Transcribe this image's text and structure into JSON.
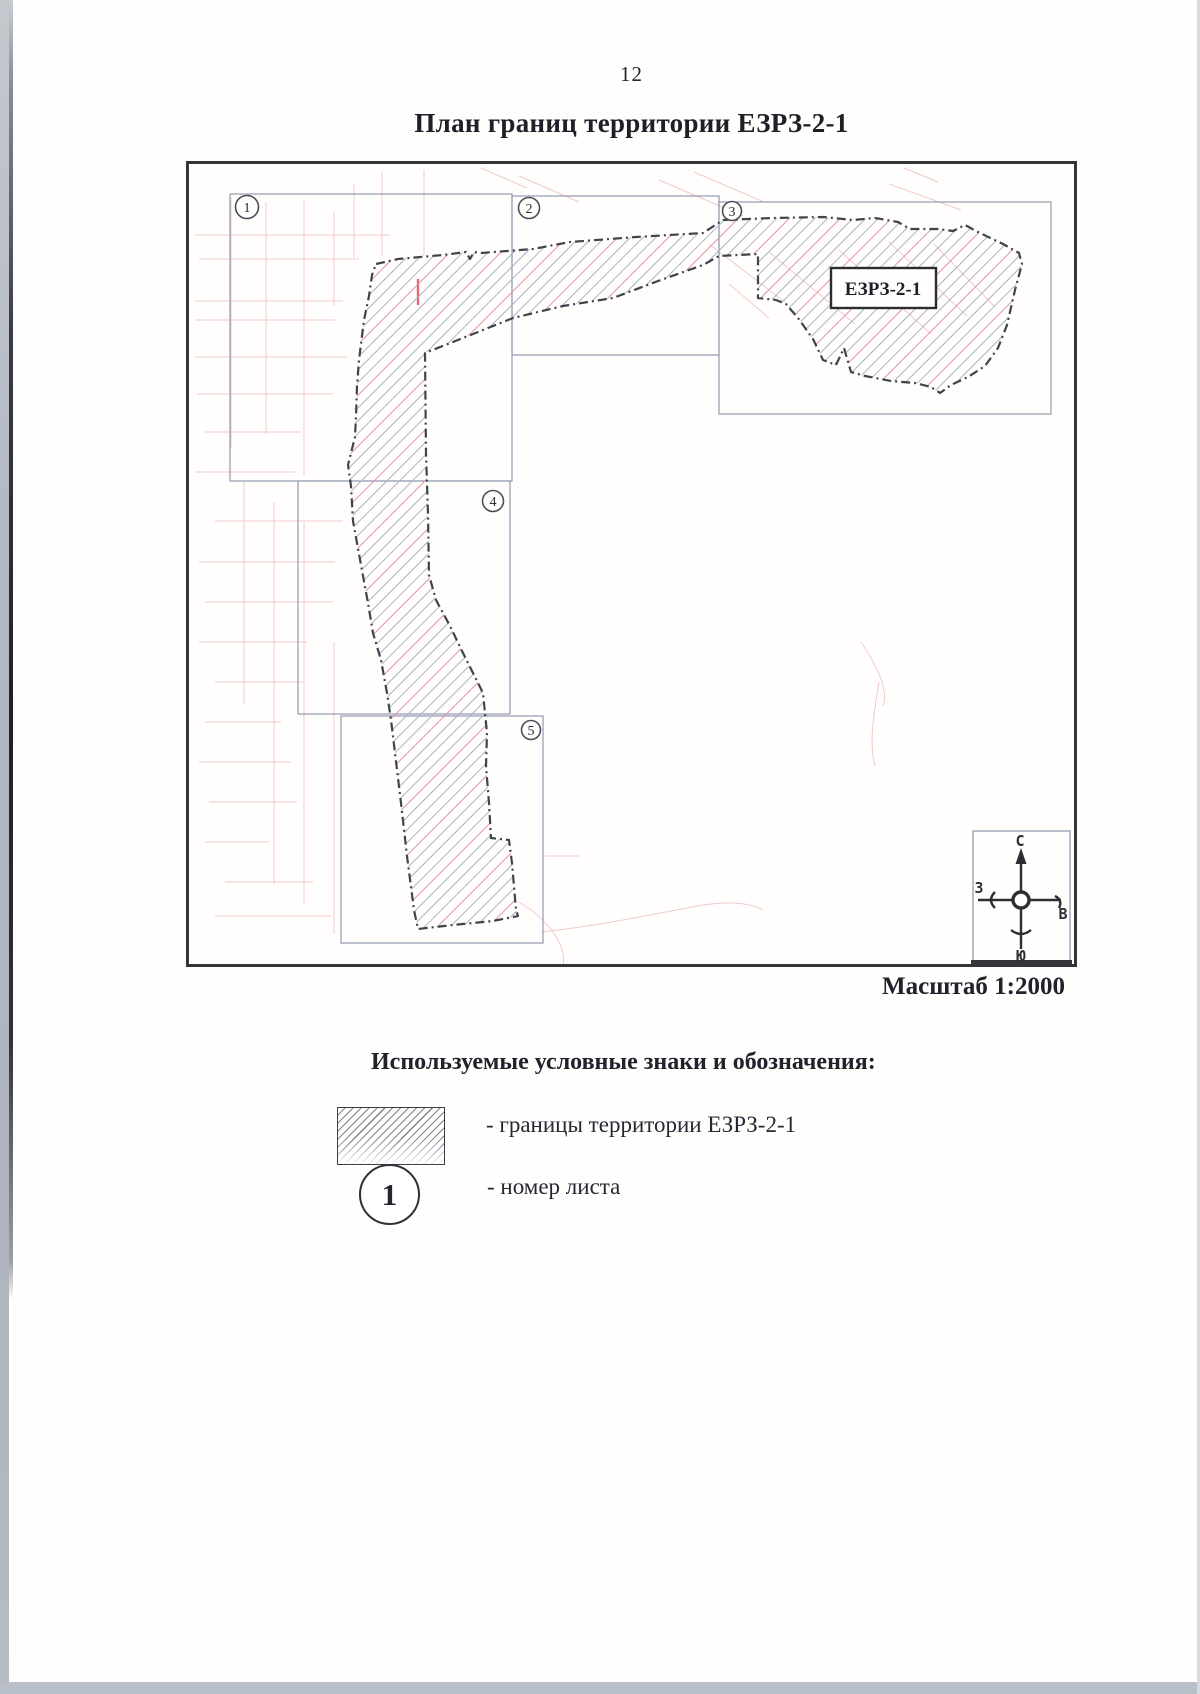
{
  "page": {
    "number": "12",
    "title": "План границ территории ЕЗРЗ-2-1"
  },
  "map": {
    "region_label": "ЕЗРЗ-2-1",
    "scale": "Масштаб 1:2000",
    "sheets": [
      {
        "number": "1"
      },
      {
        "number": "2"
      },
      {
        "number": "3"
      },
      {
        "number": "4"
      },
      {
        "number": "5"
      }
    ],
    "compass": {
      "north": "С",
      "south": "Ю",
      "west": "З",
      "east": "В"
    }
  },
  "legend": {
    "heading": "Используемые условные знаки и обозначения:",
    "items": [
      {
        "label": "- границы территории ЕЗРЗ-2-1"
      },
      {
        "symbol_text": "1",
        "label": "- номер листа"
      }
    ]
  },
  "colors": {
    "boundary": "#3f444c",
    "grid": "#8791a8",
    "cadastral_pink": "#e89cab",
    "ink": "#23252e"
  }
}
